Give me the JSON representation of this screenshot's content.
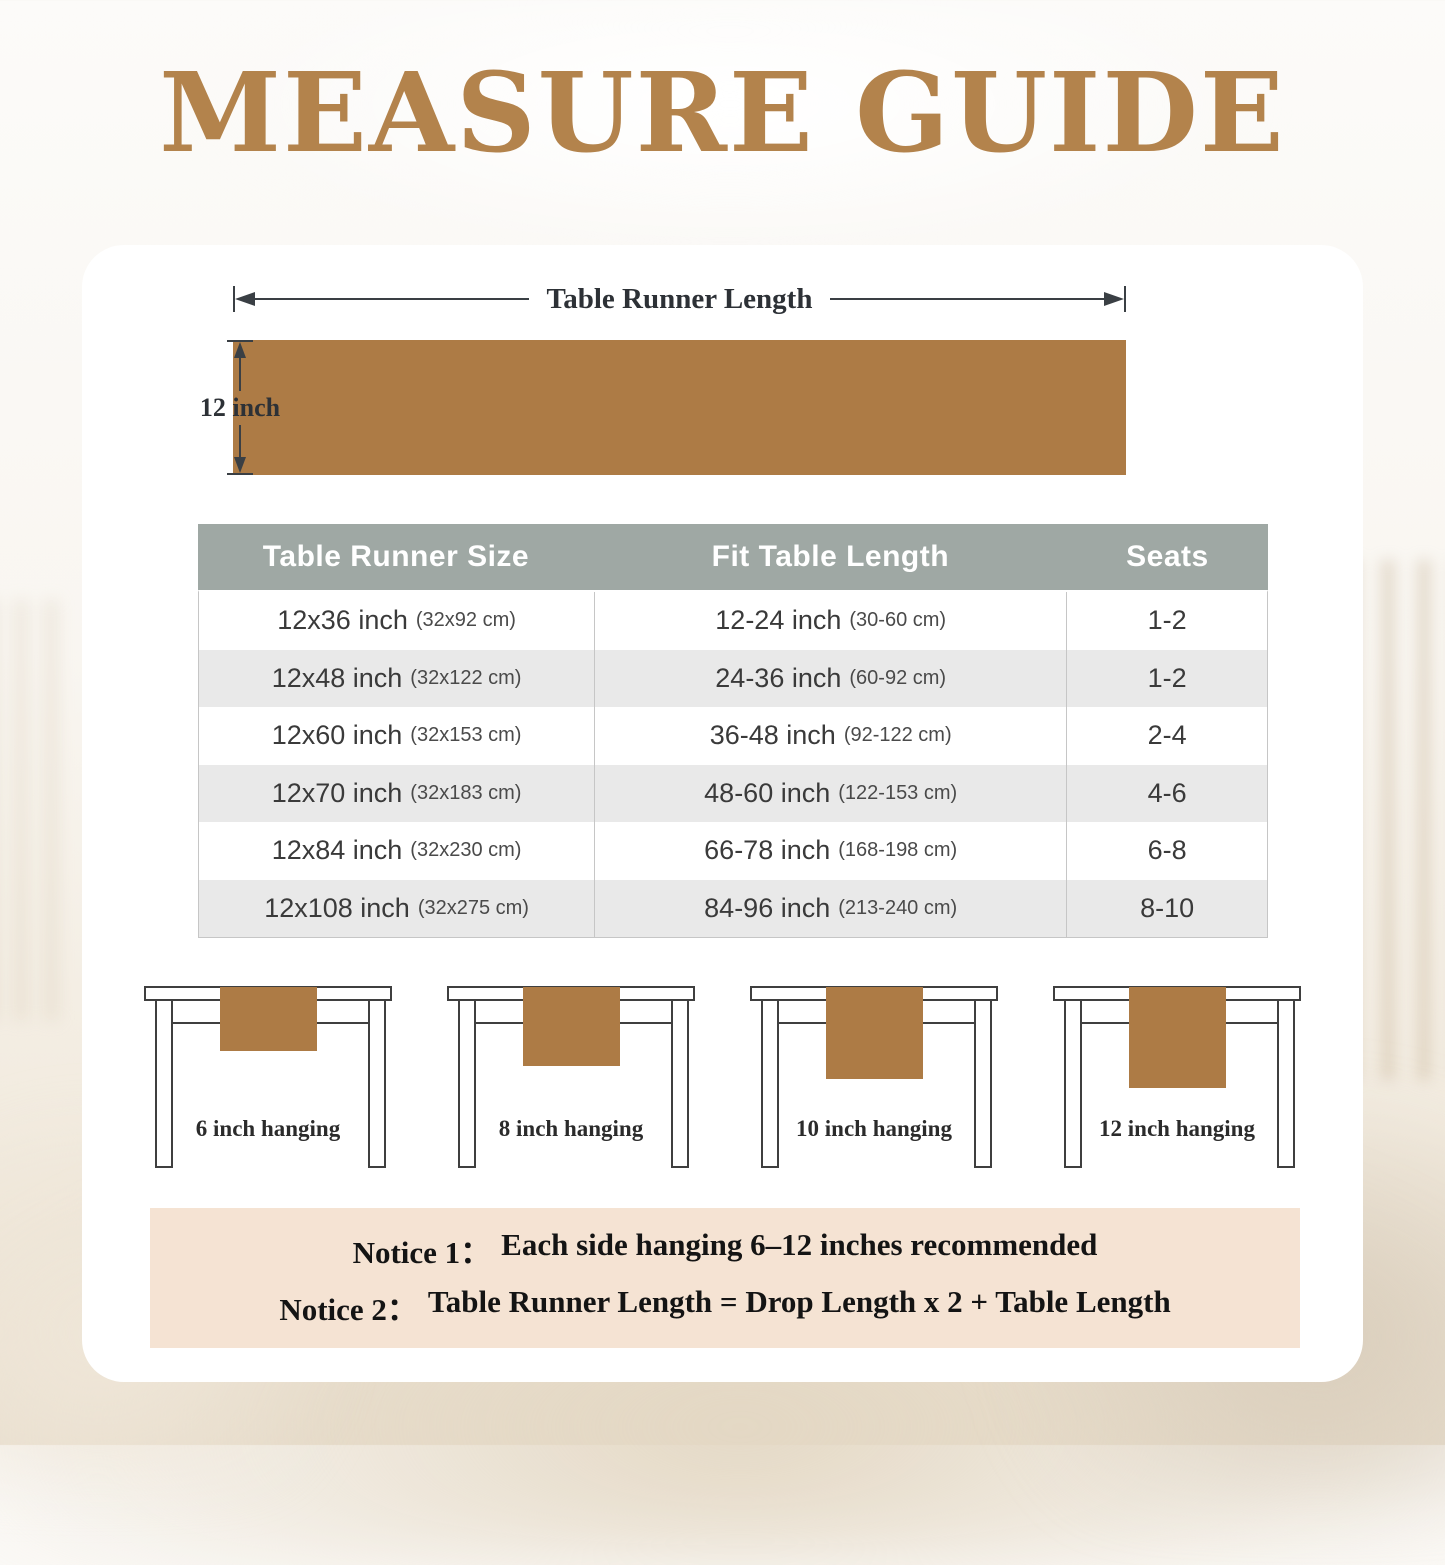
{
  "page": {
    "title": "MEASURE GUIDE"
  },
  "diagram": {
    "length_label": "Table Runner Length",
    "width_label": "12 inch"
  },
  "size_table": {
    "headers": [
      "Table Runner Size",
      "Fit Table Length",
      "Seats"
    ],
    "rows": [
      {
        "size": "12x36 inch",
        "size_cm": "(32x92 cm)",
        "fit": "12-24 inch",
        "fit_cm": "(30-60 cm)",
        "seats": "1-2"
      },
      {
        "size": "12x48 inch",
        "size_cm": "(32x122 cm)",
        "fit": "24-36 inch",
        "fit_cm": "(60-92 cm)",
        "seats": "1-2"
      },
      {
        "size": "12x60 inch",
        "size_cm": "(32x153 cm)",
        "fit": "36-48 inch",
        "fit_cm": "(92-122 cm)",
        "seats": "2-4"
      },
      {
        "size": "12x70 inch",
        "size_cm": "(32x183 cm)",
        "fit": "48-60 inch",
        "fit_cm": "(122-153 cm)",
        "seats": "4-6"
      },
      {
        "size": "12x84 inch",
        "size_cm": "(32x230 cm)",
        "fit": "66-78 inch",
        "fit_cm": "(168-198 cm)",
        "seats": "6-8"
      },
      {
        "size": "12x108 inch",
        "size_cm": "(32x275 cm)",
        "fit": "84-96 inch",
        "fit_cm": "(213-240 cm)",
        "seats": "8-10"
      }
    ]
  },
  "hanging_examples": [
    {
      "label": "6 inch hanging"
    },
    {
      "label": "8 inch hanging"
    },
    {
      "label": "10 inch hanging"
    },
    {
      "label": "12 inch hanging"
    }
  ],
  "notices": {
    "notice1_label": "Notice 1：",
    "notice1_text": "Each side hanging 6–12 inches recommended",
    "notice2_label": "Notice 2：",
    "notice2_text": "Table Runner Length = Drop Length x 2 + Table Length"
  },
  "colors": {
    "accent_brown": "#ad7b45",
    "title_brown": "#b3834c",
    "table_header_gray": "#9fa8a4",
    "row_alt_gray": "#e9e9e9",
    "notice_beige": "#f5e3d3"
  }
}
